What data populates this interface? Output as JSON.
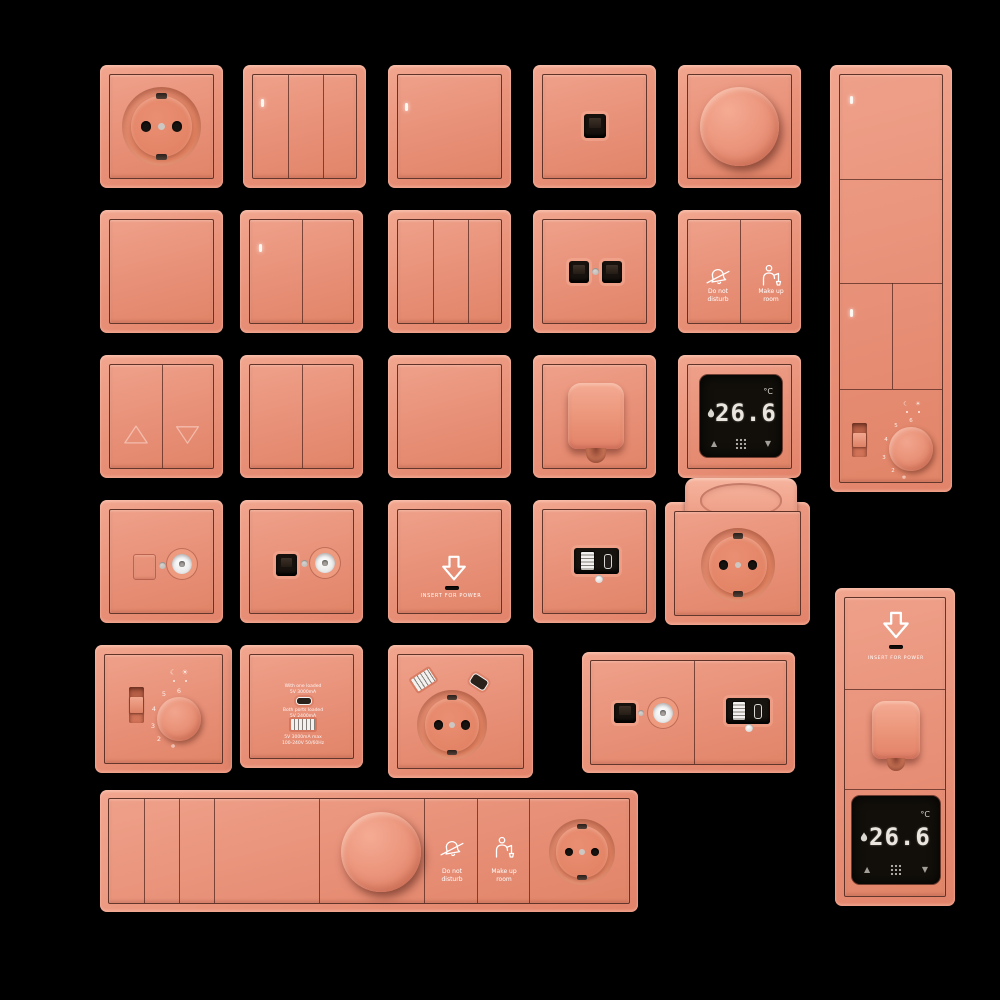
{
  "scene": {
    "background": "#000000"
  },
  "colors": {
    "product": "#e9907a",
    "product_light": "#f3ab94",
    "product_dark": "#d97a5e",
    "hairline": "#4a241c",
    "module_black": "#17130f",
    "text_white": "#ffffff",
    "display_bg": "#120f0a",
    "display_digits": "#eae6df",
    "metal_gray": "#c9c4c0"
  },
  "labels": {
    "insert_for_power": "INSERT FOR POWER",
    "do_not_disturb": [
      "Do not",
      "disturb"
    ],
    "make_up_room": [
      "Make up",
      "room"
    ]
  },
  "thermostat_display": {
    "temperature": "26.6",
    "unit": "°C",
    "up": "▲",
    "down": "▼"
  },
  "rotary_thermostat": {
    "scale_marks": [
      "6",
      "5",
      "4",
      "3",
      "2"
    ],
    "frost_mark": "❄",
    "night_icon": "☾",
    "day_icon": "☀"
  },
  "usb_charger_labels": {
    "top": [
      "With one loaded",
      "5V 3000mA"
    ],
    "middle": [
      "Both ports loaded",
      "5V 2400mA"
    ],
    "bottom": [
      "5V 3000mA max",
      "100-240V 50/60Hz"
    ]
  },
  "icons": {
    "do_not_disturb": "bell-slash",
    "make_up_room": "housekeeper-person",
    "insert_card": "arrow-down-outline",
    "heating": "flame",
    "night": "☾",
    "day": "☀",
    "frost": "❄",
    "up_arrow": "▲",
    "down_arrow": "▼",
    "blinds_up": "triangle-up-outline",
    "blinds_down": "triangle-down-outline",
    "menu": "dot-grid"
  }
}
